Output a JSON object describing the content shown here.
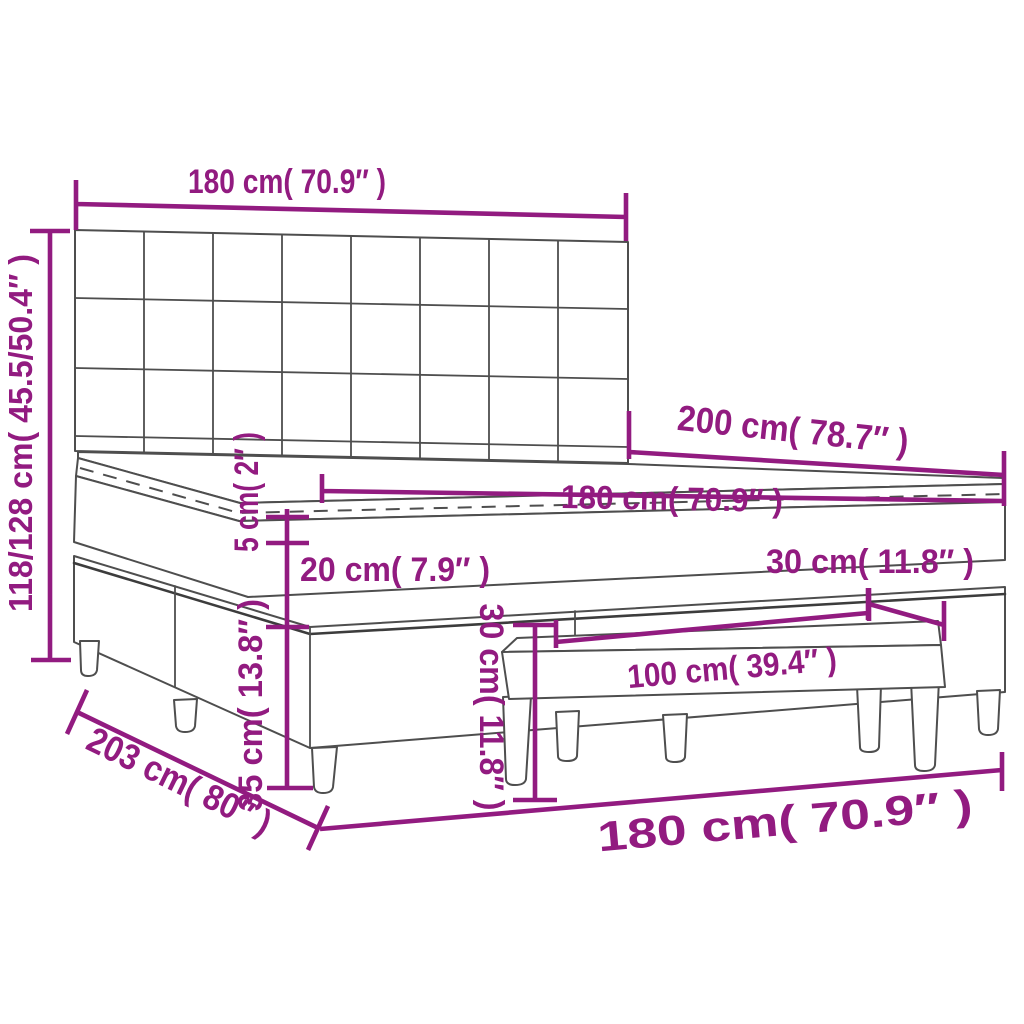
{
  "diagram": {
    "subject": "box-spring bed with tufted headboard, topper, mattress, base and bench — dimension drawing",
    "colors": {
      "dimension_accent": "#921b80",
      "drawing_outline": "#4e4e4e",
      "background": "#ffffff"
    },
    "labels": {
      "headboard_width": "180 cm( 70.9″ )",
      "headboard_height": "118/128 cm( 45.5/50.4″ )",
      "bed_length": "200 cm( 78.7″ )",
      "mattress_width": "180 cm( 70.9″ )",
      "topper_thickness": "5 cm( 2″ )",
      "mattress_thickness": "20 cm( 7.9″ )",
      "bench_depth": "30 cm( 11.8″ )",
      "base_height": "35 cm( 13.8″ )",
      "bench_height": "30 cm( 11.8″ )",
      "bench_length": "100 cm( 39.4″ )",
      "frame_total_length": "203 cm( 80″ )",
      "bed_width": "180 cm( 70.9″ )"
    }
  }
}
